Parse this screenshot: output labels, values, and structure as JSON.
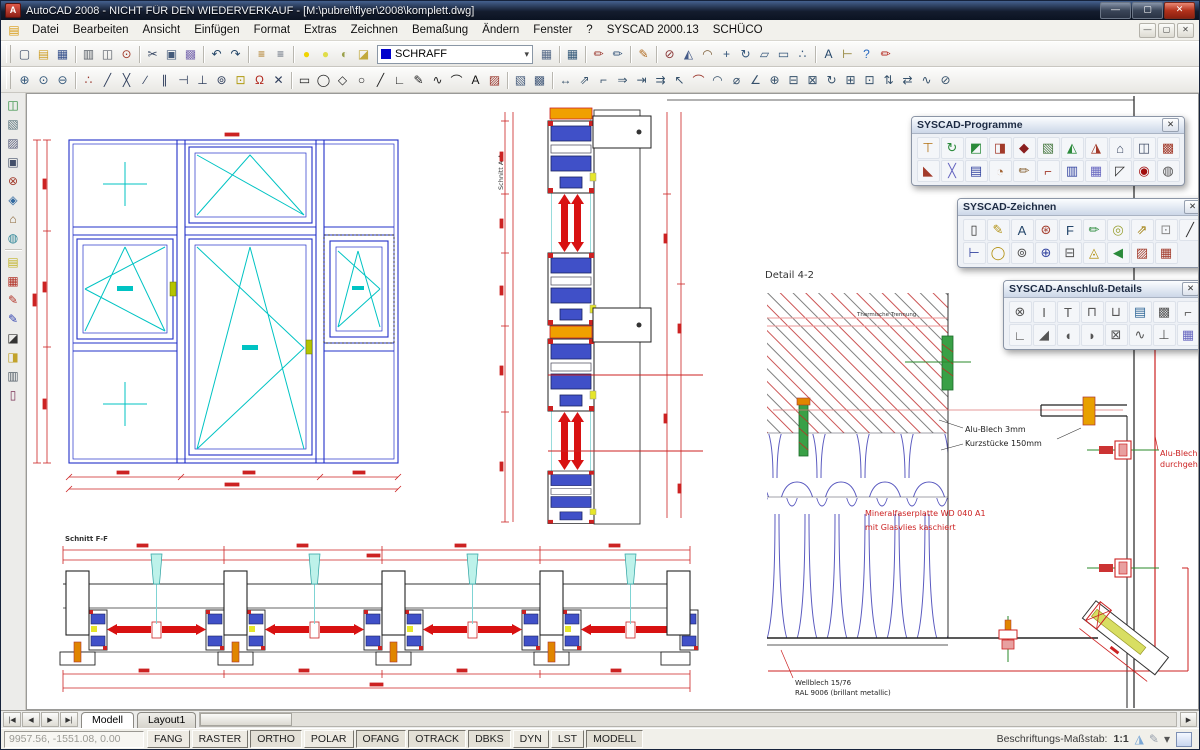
{
  "window": {
    "title": "AutoCAD 2008 - NICHT FÜR DEN WIEDERVERKAUF - [M:\\pubrel\\flyer\\2008\\komplett.dwg]",
    "controls": [
      {
        "n": "minimize",
        "g": "—"
      },
      {
        "n": "maximize",
        "g": "▢"
      },
      {
        "n": "close",
        "g": "✕",
        "cls": "close"
      }
    ],
    "doc_controls": [
      {
        "n": "doc-minimize",
        "g": "—"
      },
      {
        "n": "doc-restore",
        "g": "▢"
      },
      {
        "n": "doc-close",
        "g": "✕"
      }
    ]
  },
  "menu": {
    "items": [
      "Datei",
      "Bearbeiten",
      "Ansicht",
      "Einfügen",
      "Format",
      "Extras",
      "Zeichnen",
      "Bemaßung",
      "Ändern",
      "Fenster",
      "?",
      "SYSCAD 2000.13",
      "SCHÜCO"
    ]
  },
  "layer_combo": {
    "value": "SCHRAFF",
    "arrow": "▾",
    "swatch_color": "#0000cc"
  },
  "toolbars": {
    "row1a": [
      {
        "n": "new-file",
        "g": "▢",
        "c": "#3a4a66"
      },
      {
        "n": "open-file",
        "g": "▤",
        "c": "#cfa02a"
      },
      {
        "n": "save-file",
        "g": "▦",
        "c": "#35508c"
      },
      {
        "sep": true
      },
      {
        "n": "print",
        "g": "▥",
        "c": "#5a6068"
      },
      {
        "n": "plot-preview",
        "g": "◫",
        "c": "#5a6068"
      },
      {
        "n": "zoom-search",
        "g": "⊙",
        "c": "#a23a2a"
      },
      {
        "sep": true
      },
      {
        "n": "cut",
        "g": "✂",
        "c": "#3a4a66"
      },
      {
        "n": "copy",
        "g": "▣",
        "c": "#445a7a"
      },
      {
        "n": "paste",
        "g": "▩",
        "c": "#7a6ab0"
      },
      {
        "sep": true
      },
      {
        "n": "undo",
        "g": "↶",
        "c": "#224466"
      },
      {
        "n": "redo",
        "g": "↷",
        "c": "#224466"
      },
      {
        "sep": true
      },
      {
        "n": "layer-previous",
        "g": "≡",
        "c": "#a87012"
      },
      {
        "n": "layer-manager",
        "g": "≡",
        "c": "#556070"
      },
      {
        "sep": true
      },
      {
        "n": "layer-on",
        "g": "●",
        "c": "#f0d400"
      },
      {
        "n": "layer-thaw",
        "g": "●",
        "c": "#e0dd4a"
      },
      {
        "n": "layer-unlock",
        "g": "◐",
        "c": "#9aa04a"
      },
      {
        "n": "layer-plot",
        "g": "◪",
        "c": "#c2a93c"
      }
    ],
    "row1b": [
      {
        "n": "layer-states",
        "g": "▦",
        "c": "#566a88"
      },
      {
        "sep": true
      },
      {
        "n": "properties-table",
        "g": "▦",
        "c": "#355a7a"
      },
      {
        "sep": true
      },
      {
        "n": "match-properties",
        "g": "✏",
        "c": "#99342a"
      },
      {
        "n": "match-layer",
        "g": "✏",
        "c": "#35557a"
      },
      {
        "sep": true
      },
      {
        "n": "edit-pencil",
        "g": "✎",
        "c": "#b06a1f"
      },
      {
        "sep": true
      },
      {
        "n": "erase",
        "g": "⊘",
        "c": "#883333"
      },
      {
        "n": "mirror",
        "g": "◭",
        "c": "#445a88"
      },
      {
        "n": "offset",
        "g": "◠",
        "c": "#7a5a33"
      },
      {
        "n": "move",
        "g": "+",
        "c": "#33557a"
      },
      {
        "n": "rotate",
        "g": "↻",
        "c": "#33557a"
      },
      {
        "n": "scale",
        "g": "▱",
        "c": "#33557a"
      },
      {
        "n": "stretch",
        "g": "▭",
        "c": "#33557a"
      },
      {
        "n": "snap-to",
        "g": "∴",
        "c": "#33557a"
      },
      {
        "sep": true
      },
      {
        "n": "text-edit",
        "g": "A",
        "c": "#24466a"
      },
      {
        "n": "dim-ruler",
        "g": "⊢",
        "c": "#887722"
      },
      {
        "n": "help",
        "g": "?",
        "c": "#2a6ac0"
      },
      {
        "n": "sketch-brush",
        "g": "✏",
        "c": "#b22218"
      }
    ],
    "row2": [
      {
        "n": "zoom-window",
        "g": "⊕",
        "c": "#33577a"
      },
      {
        "n": "zoom-object",
        "g": "⊙",
        "c": "#33577a"
      },
      {
        "n": "zoom-previous",
        "g": "⊖",
        "c": "#33577a"
      },
      {
        "sep": true
      },
      {
        "n": "snap-refpoint",
        "g": "∴",
        "c": "#99342a"
      },
      {
        "n": "snap-endpoint",
        "g": "╱",
        "c": "#2f3e5c"
      },
      {
        "n": "snap-intersection",
        "g": "╳",
        "c": "#2f3e5c"
      },
      {
        "n": "snap-midpoint",
        "g": "∕",
        "c": "#2f3e5c"
      },
      {
        "n": "snap-parallel",
        "g": "∥",
        "c": "#2f3e5c"
      },
      {
        "n": "snap-extension",
        "g": "⊣",
        "c": "#2f3e5c"
      },
      {
        "n": "snap-perpendicular",
        "g": "⊥",
        "c": "#2f3e5c"
      },
      {
        "n": "snap-center",
        "g": "⊚",
        "c": "#2f3e5c"
      },
      {
        "n": "snap-node",
        "g": "⊡",
        "c": "#b09a10"
      },
      {
        "n": "snap-magnet",
        "g": "Ω",
        "c": "#b2281e"
      },
      {
        "n": "snap-off",
        "g": "✕",
        "c": "#2f3e5c"
      },
      {
        "sep": true
      },
      {
        "n": "draw-rectangle",
        "g": "▭",
        "c": "#222222"
      },
      {
        "n": "draw-circle",
        "g": "◯",
        "c": "#222222"
      },
      {
        "n": "draw-polygon",
        "g": "◇",
        "c": "#222222"
      },
      {
        "n": "draw-ellipse",
        "g": "○",
        "c": "#222222"
      },
      {
        "n": "draw-line",
        "g": "╱",
        "c": "#222222"
      },
      {
        "n": "draw-polyline",
        "g": "∟",
        "c": "#222222"
      },
      {
        "n": "draw-pencil",
        "g": "✎",
        "c": "#222222"
      },
      {
        "n": "draw-spline",
        "g": "∿",
        "c": "#222222"
      },
      {
        "n": "draw-arc",
        "g": "⌒",
        "c": "#222222"
      },
      {
        "n": "draw-text",
        "g": "A",
        "c": "#111111"
      },
      {
        "n": "draw-hatch",
        "g": "▨",
        "c": "#99342a"
      },
      {
        "sep": true
      },
      {
        "n": "wipeout",
        "g": "▧",
        "c": "#445a7a"
      },
      {
        "n": "image-frame",
        "g": "▩",
        "c": "#445a7a"
      },
      {
        "sep": true
      },
      {
        "n": "dim-linear",
        "g": "↔",
        "c": "#35506a"
      },
      {
        "n": "dim-aligned",
        "g": "⇗",
        "c": "#35506a"
      },
      {
        "n": "dim-ordinate",
        "g": "⌐",
        "c": "#35506a"
      },
      {
        "n": "dim-baseline",
        "g": "⇒",
        "c": "#35506a"
      },
      {
        "n": "dim-continue",
        "g": "⇥",
        "c": "#35506a"
      },
      {
        "n": "dim-quick",
        "g": "⇉",
        "c": "#35506a"
      },
      {
        "n": "dim-leader",
        "g": "↖",
        "c": "#35506a"
      },
      {
        "n": "dim-arc",
        "g": "⌒",
        "c": "#99342a"
      },
      {
        "n": "dim-radius",
        "g": "◠",
        "c": "#35506a"
      },
      {
        "n": "dim-diameter",
        "g": "⌀",
        "c": "#35506a"
      },
      {
        "n": "dim-angular",
        "g": "∠",
        "c": "#35506a"
      },
      {
        "n": "dim-center-mark",
        "g": "⊕",
        "c": "#35506a"
      },
      {
        "n": "dim-edit",
        "g": "⊟",
        "c": "#35506a"
      },
      {
        "n": "dim-text-edit",
        "g": "⊠",
        "c": "#35506a"
      },
      {
        "n": "dim-update",
        "g": "↻",
        "c": "#35506a"
      },
      {
        "n": "dim-tolerance",
        "g": "⊞",
        "c": "#35506a"
      },
      {
        "n": "dim-style",
        "g": "⊡",
        "c": "#35506a"
      },
      {
        "n": "dim-space",
        "g": "⇅",
        "c": "#35506a"
      },
      {
        "n": "dim-break",
        "g": "⇄",
        "c": "#35506a"
      },
      {
        "n": "dim-jog",
        "g": "∿",
        "c": "#35506a"
      },
      {
        "n": "dim-inspect",
        "g": "⊘",
        "c": "#35506a"
      }
    ],
    "left": [
      {
        "n": "syscad-logo",
        "g": "◫",
        "c": "#2a8a3a"
      },
      {
        "n": "sheet-zoom",
        "g": "▧",
        "c": "#55707a"
      },
      {
        "n": "sheet-edit",
        "g": "▨",
        "c": "#555a7a"
      },
      {
        "n": "block-reference",
        "g": "▣",
        "c": "#44506a"
      },
      {
        "n": "erase-tool",
        "g": "⊗",
        "c": "#a23a2a"
      },
      {
        "n": "views-tool",
        "g": "◈",
        "c": "#336aa0"
      },
      {
        "n": "building-tool",
        "g": "⌂",
        "c": "#886233"
      },
      {
        "n": "world-tool",
        "g": "◍",
        "c": "#338899"
      },
      {
        "sep": true
      },
      {
        "n": "sheet-new",
        "g": "▤",
        "c": "#c2b42a"
      },
      {
        "n": "grid-red",
        "g": "▦",
        "c": "#b23328"
      },
      {
        "n": "pen-red",
        "g": "✎",
        "c": "#b23328"
      },
      {
        "n": "pens-blue",
        "g": "✎",
        "c": "#3344b0"
      },
      {
        "n": "modify-black",
        "g": "◪",
        "c": "#333333"
      },
      {
        "n": "id-yellow",
        "g": "◨",
        "c": "#c2a22a"
      },
      {
        "n": "list-sheet",
        "g": "▥",
        "c": "#55606a"
      },
      {
        "n": "door-tool",
        "g": "▯",
        "c": "#7a3355"
      }
    ]
  },
  "palettes": [
    {
      "title": "SYSCAD-Programme",
      "row1": [
        {
          "n": "mast-tool",
          "g": "⊤",
          "c": "#b27010"
        },
        {
          "n": "refresh-db",
          "g": "↻",
          "c": "#2a8a3a"
        },
        {
          "n": "profile-green",
          "g": "◩",
          "c": "#2a8a3a"
        },
        {
          "n": "case-red",
          "g": "◨",
          "c": "#a23a2a"
        },
        {
          "n": "schueco-emblem",
          "g": "◆",
          "c": "#8a1f1f"
        },
        {
          "n": "image-green",
          "g": "▧",
          "c": "#4a7a44"
        },
        {
          "n": "book-green",
          "g": "◭",
          "c": "#2a8a3a"
        },
        {
          "n": "runner-red",
          "g": "◮",
          "c": "#a23a2a"
        },
        {
          "n": "house-plan",
          "g": "⌂",
          "c": "#44506a"
        },
        {
          "n": "profile-blue",
          "g": "◫",
          "c": "#44506a"
        },
        {
          "n": "panel-red",
          "g": "▩",
          "c": "#a23a2a"
        }
      ],
      "row2": [
        {
          "n": "wedge-red",
          "g": "◣",
          "c": "#a23a2a"
        },
        {
          "n": "user-cross",
          "g": "╳",
          "c": "#6666c0"
        },
        {
          "n": "list-blue",
          "g": "▤",
          "c": "#3344a0"
        },
        {
          "n": "percent-tool",
          "g": "◔",
          "c": "#a26333"
        },
        {
          "n": "brush-tool",
          "g": "✏",
          "c": "#886233"
        },
        {
          "n": "pipe-tool",
          "g": "⌐",
          "c": "#a23a2a"
        },
        {
          "n": "truck-tool",
          "g": "▥",
          "c": "#3344a0"
        },
        {
          "n": "cabinet-tool",
          "g": "▦",
          "c": "#6666c0"
        },
        {
          "n": "flag-corner",
          "g": "◸",
          "c": "#333333"
        },
        {
          "n": "target-red",
          "g": "◉",
          "c": "#a21010"
        },
        {
          "n": "cd-tool",
          "g": "◍",
          "c": "#555555"
        }
      ]
    },
    {
      "title": "SYSCAD-Zeichnen",
      "row1": [
        {
          "n": "block-editor",
          "g": "▯",
          "c": "#333333"
        },
        {
          "n": "pencil-yellow",
          "g": "✎",
          "c": "#b29010"
        },
        {
          "n": "text-a",
          "g": "A",
          "c": "#24466a"
        },
        {
          "n": "sb-tool",
          "g": "⊛",
          "c": "#a23a2a"
        },
        {
          "n": "f-pencil",
          "g": "F",
          "c": "#24466a"
        },
        {
          "n": "sign-pencil",
          "g": "✏",
          "c": "#2a8a3a"
        },
        {
          "n": "eye-bubble",
          "g": "◎",
          "c": "#99a033"
        },
        {
          "n": "jx-move",
          "g": "⇗",
          "c": "#a28010"
        },
        {
          "n": "dot-box",
          "g": "⊡",
          "c": "#888888"
        },
        {
          "n": "diagonal-line",
          "g": "╱",
          "c": "#333333"
        }
      ],
      "row2": [
        {
          "n": "dim-chain",
          "g": "⊢",
          "c": "#3344a0"
        },
        {
          "n": "oval-tool",
          "g": "◯",
          "c": "#b29010"
        },
        {
          "n": "rings-tool",
          "g": "⊚",
          "c": "#555555"
        },
        {
          "n": "target-move",
          "g": "⊕",
          "c": "#3344a0"
        },
        {
          "n": "numbers-tool",
          "g": "⊟",
          "c": "#555555"
        },
        {
          "n": "cone-warning",
          "g": "◬",
          "c": "#b29010"
        },
        {
          "n": "flag-select",
          "g": "◀",
          "c": "#2a8a3a"
        },
        {
          "n": "hatch-red",
          "g": "▨",
          "c": "#a23a2a"
        },
        {
          "n": "table-red",
          "g": "▦",
          "c": "#a23a2a"
        }
      ]
    },
    {
      "title": "SYSCAD-Anschluß-Details",
      "row1": [
        {
          "n": "anchor-detail",
          "g": "⊗",
          "c": "#555555"
        },
        {
          "n": "i-beam",
          "g": "I",
          "c": "#555555"
        },
        {
          "n": "t-profile",
          "g": "T",
          "c": "#555555"
        },
        {
          "n": "channel-profile",
          "g": "⊓",
          "c": "#555555"
        },
        {
          "n": "u-profile",
          "g": "⊔",
          "c": "#555555"
        },
        {
          "n": "panel-blue",
          "g": "▤",
          "c": "#336a99"
        },
        {
          "n": "hatch-box",
          "g": "▩",
          "c": "#555555"
        },
        {
          "n": "corner-profile",
          "g": "⌐",
          "c": "#555555"
        }
      ],
      "row2": [
        {
          "n": "z-profile",
          "g": "∟",
          "c": "#555555"
        },
        {
          "n": "flat-seal",
          "g": "◢",
          "c": "#555555"
        },
        {
          "n": "gasket-left",
          "g": "◖",
          "c": "#555555"
        },
        {
          "n": "gasket-right",
          "g": "◗",
          "c": "#555555"
        },
        {
          "n": "x-box",
          "g": "⊠",
          "c": "#555555"
        },
        {
          "n": "spring-detail",
          "g": "∿",
          "c": "#555555"
        },
        {
          "n": "bolt-t",
          "g": "⊥",
          "c": "#555555"
        },
        {
          "n": "www-panel",
          "g": "▦",
          "c": "#6666c0"
        }
      ]
    }
  ],
  "ui": {
    "close": "✕"
  },
  "drawing": {
    "labels": {
      "detail_title": "Detail  4-2",
      "thermal": "Thermische Trennung",
      "alu_kurz_1": "Alu-Blech 3mm",
      "alu_kurz_2": "Kurzstücke 150mm",
      "alu_durch_1": "Alu-Blech",
      "alu_durch_2": "durchgehend",
      "mineral_1": "Mineralfaserplatte WD 040 A1",
      "mineral_2": "mit Glasvlies kaschiert",
      "wellblech_1": "Wellblech 15/76",
      "wellblech_2": "RAL 9006 (brillant metallic)",
      "section_a": "Schnitt A-A",
      "section_f": "Schnitt F-F"
    }
  },
  "tabs": {
    "nav": [
      {
        "n": "first-tab",
        "g": "|◀"
      },
      {
        "n": "prev-tab",
        "g": "◀"
      },
      {
        "n": "next-tab",
        "g": "▶"
      },
      {
        "n": "last-tab",
        "g": "▶|"
      }
    ],
    "model": "Modell",
    "layout1": "Layout1",
    "scroll_right": "▶"
  },
  "statusbar": {
    "coords": "9957.56, -1551.08, 0.00",
    "toggles": [
      {
        "label": "FANG"
      },
      {
        "label": "RASTER"
      },
      {
        "label": "ORTHO",
        "pressed": true
      },
      {
        "label": "POLAR"
      },
      {
        "label": "OFANG",
        "pressed": true
      },
      {
        "label": "OTRACK",
        "pressed": true
      },
      {
        "label": "DBKS",
        "pressed": true
      },
      {
        "label": "DYN"
      },
      {
        "label": "LST"
      },
      {
        "label": "MODELL",
        "pressed": true
      }
    ],
    "annotation_label": "Beschriftungs-Maßstab:",
    "annotation_scale": "1:1",
    "tools": [
      {
        "n": "annotation-visibility",
        "g": "◮",
        "c": "#7aa7d6"
      },
      {
        "n": "annotation-autoscale",
        "g": "✎",
        "c": "#98a0ac"
      },
      {
        "n": "scale-menu-arrow",
        "g": "▾",
        "c": "#555555"
      }
    ]
  },
  "colors": {
    "dim_red": "#cc2222",
    "frame_blue": "#2230c8",
    "sash_cyan": "#00c3c3",
    "wool_blue": "#5a5ac0"
  }
}
